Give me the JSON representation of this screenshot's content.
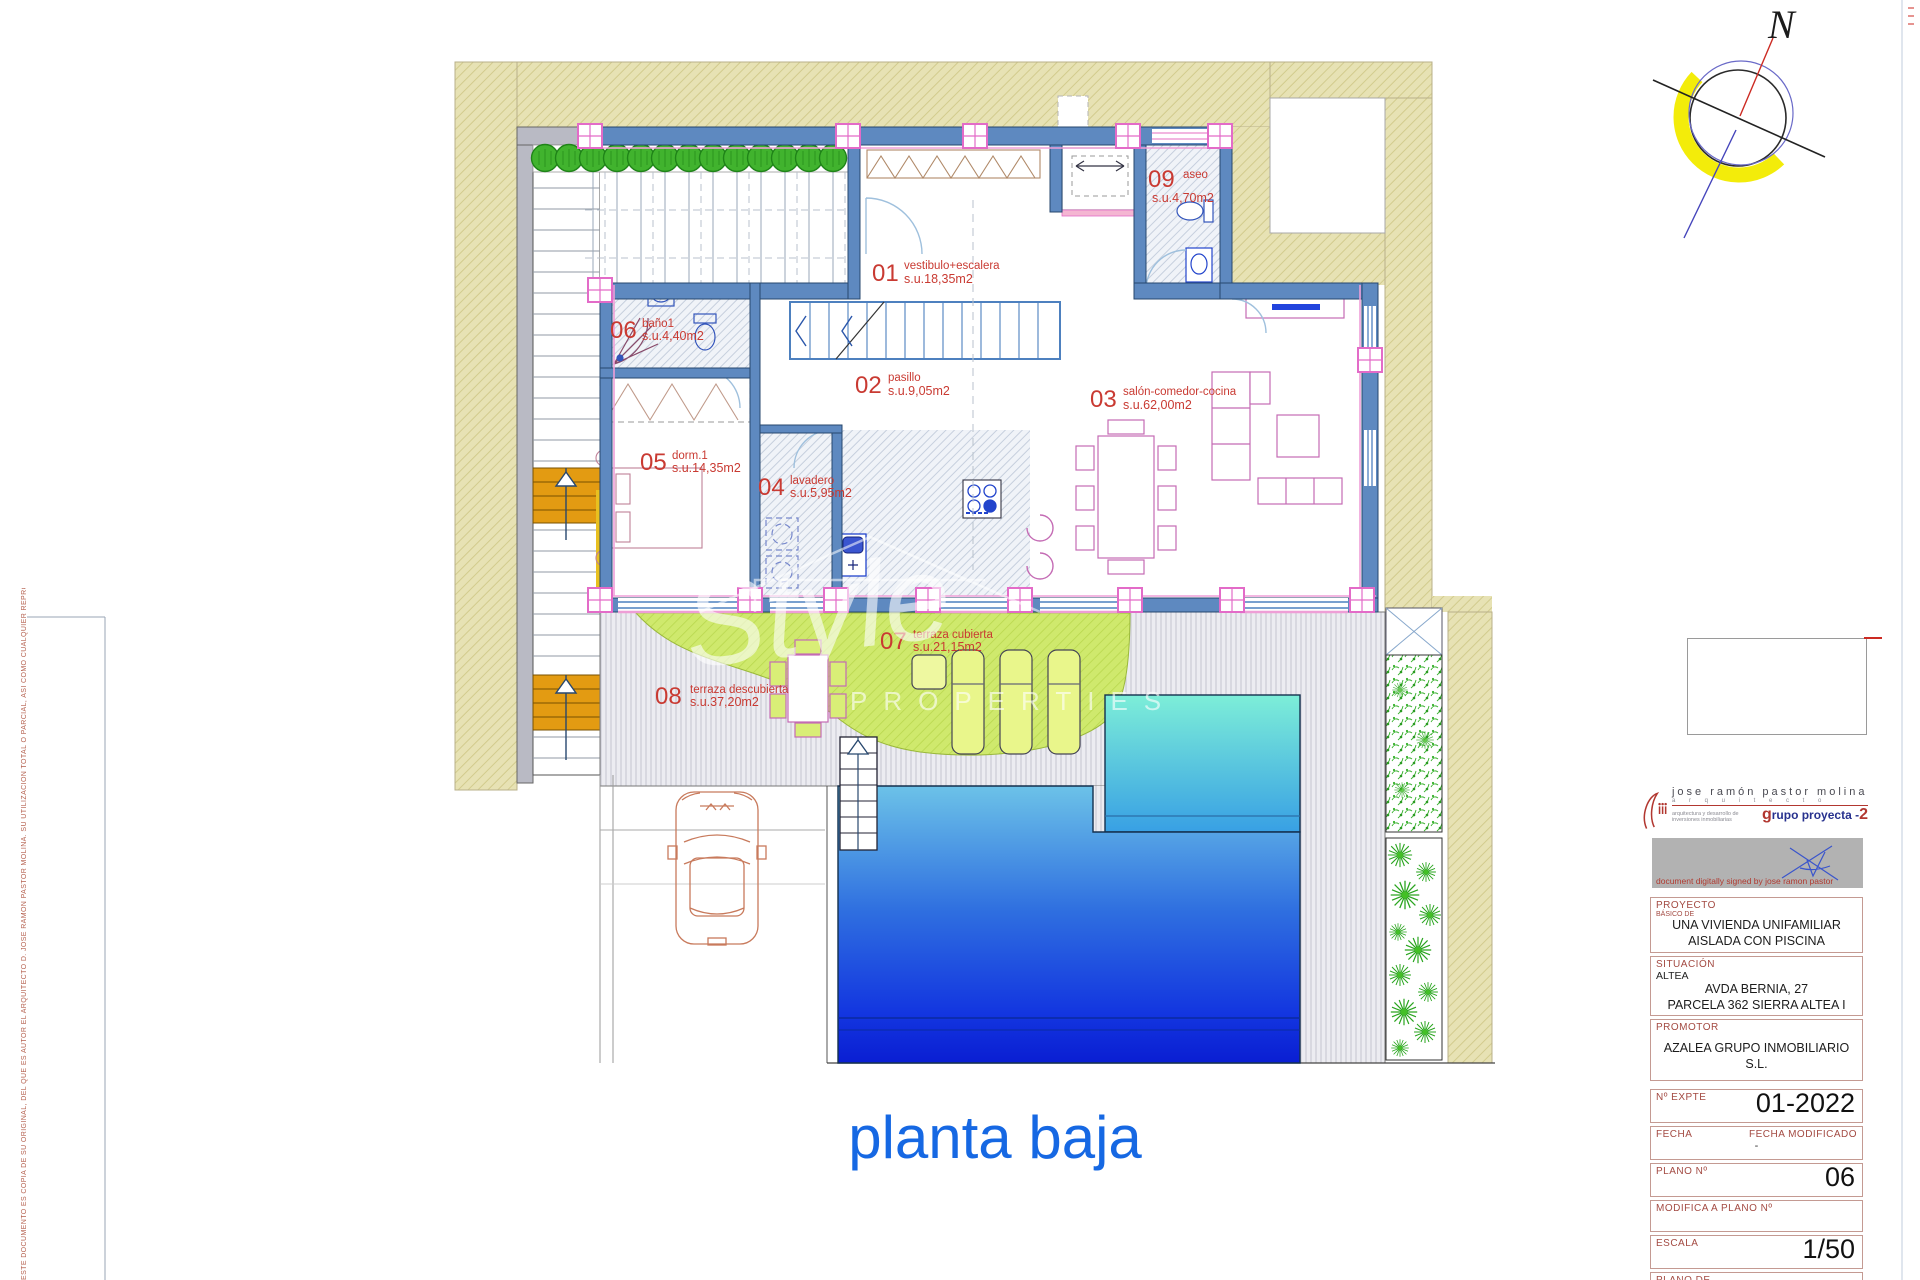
{
  "page": {
    "main_title": "planta baja"
  },
  "compass": {
    "label": "N"
  },
  "plan": {
    "rooms": [
      {
        "num": "01",
        "name": "vestibulo+escalera",
        "area": "s.u.18,35m2"
      },
      {
        "num": "02",
        "name": "pasillo",
        "area": "s.u.9,05m2"
      },
      {
        "num": "03",
        "name": "salón-comedor-cocina",
        "area": "s.u.62,00m2"
      },
      {
        "num": "04",
        "name": "lavadero",
        "area": "s.u.5,95m2"
      },
      {
        "num": "05",
        "name": "dorm.1",
        "area": "s.u.14,35m2"
      },
      {
        "num": "06",
        "name": "baño1",
        "area": "s.u.4,40m2"
      },
      {
        "num": "07",
        "name": "terraza cubierta",
        "area": "s.u.21,15m2"
      },
      {
        "num": "08",
        "name": "terraza descubierta",
        "area": "s.u.37,20m2"
      },
      {
        "num": "09",
        "name": "aseo",
        "area": "s.u.4,70m2"
      }
    ],
    "colors": {
      "plot_band": "#e7e2b4",
      "wall_blue": "#5e89c0",
      "label_red": "#c93a32",
      "pool_deep": "#0a1ed2",
      "pool_shallow": "#7deed8",
      "terrace_lime": "#cfe96d",
      "title_blue": "#1668e3"
    }
  },
  "watermark": {
    "line1": "Style",
    "line2": "PROPERTIES"
  },
  "architect": {
    "name": "jose  ramón  pastor  molina",
    "profession": "a r q u i t e c t o",
    "tagline": "arquitectura y desarrollo de inversiones inmobiliarias",
    "group_g": "g",
    "group_mid": "rupo  proyecta -",
    "group_num": "2",
    "signature_note": "document  digitally  signed  by  jose ramon pastor"
  },
  "titleblock": {
    "proyecto_label": "PROYECTO",
    "proyecto_sub": "BÁSICO DE",
    "proyecto_line1": "UNA VIVIENDA UNIFAMILIAR",
    "proyecto_line2": "AISLADA CON PISCINA",
    "situacion_label": "SITUACIÓN",
    "situacion_city": "ALTEA",
    "situacion_line1": "AVDA  BERNIA, 27",
    "situacion_line2": "PARCELA 362 SIERRA ALTEA I",
    "promotor_label": "PROMOTOR",
    "promotor_value": "AZALEA GRUPO INMOBILIARIO S.L.",
    "expte_label": "Nº EXPTE",
    "expte_value": "01-2022",
    "fecha_label": "FECHA",
    "fecha_mod_label": "FECHA MODIFICADO",
    "fecha_mod_value": "-",
    "plano_n_label": "PLANO Nº",
    "plano_n_value": "06",
    "modifica_label": "MODIFICA A PLANO Nº",
    "modifica_value": "",
    "escala_label": "ESCALA",
    "escala_value": "1/50",
    "plano_de_label": "PLANO DE",
    "plano_de_value": "PLANTA BAJA"
  },
  "disclaimer": "ESTE DOCUMENTO ES COPIA DE SU ORIGINAL, DEL QUE ES AUTOR EL ARQUITECTO D. JOSE RAMON PASTOR MOLINA. SU UTILIZACION TOTAL O PARCIAL, ASI COMO CUALQUIER REPRODUCCION O CESION A TERCEROS, REQUERIRA LA PREVIA AUTORIZACION EXPRESA DE SU AUTOR, QUEDANDO EN TODO CASO PROHIBIDA CUALQUIER MODIFICACION UNILATERAL DEL MISMO"
}
